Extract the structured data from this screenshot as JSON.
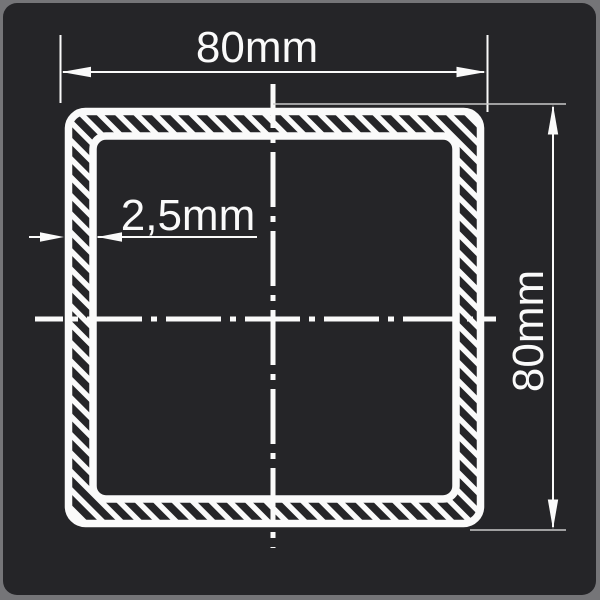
{
  "drawing": {
    "title": "square-tube-cross-section",
    "dimensions": {
      "width_label": "80mm",
      "height_label": "80mm",
      "thickness_label": "2,5mm"
    },
    "colors": {
      "page_background": "#757578",
      "panel_background": "#252528",
      "line_color": "#fafafa",
      "extension_line_color": "#c9c9c9"
    }
  }
}
